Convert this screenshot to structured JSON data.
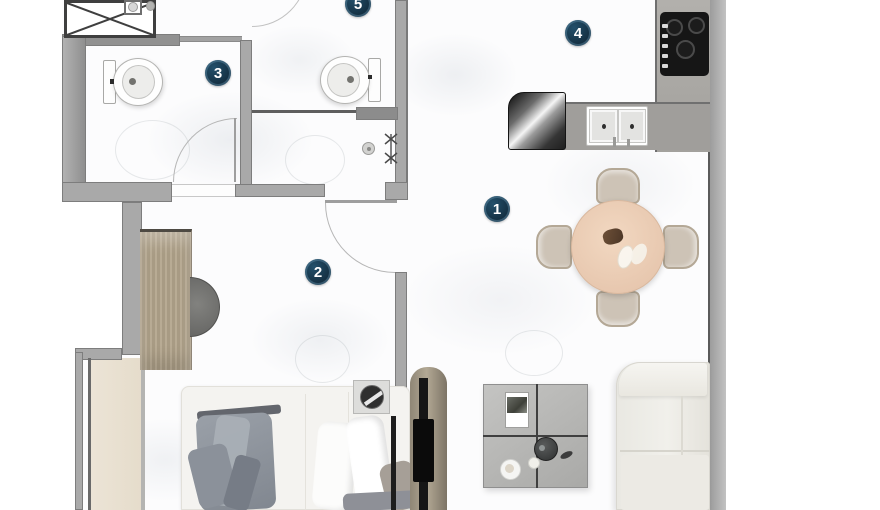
{
  "plan": {
    "type": "apartment-floor-plan",
    "badges": [
      {
        "label": "1"
      },
      {
        "label": "2"
      },
      {
        "label": "3"
      },
      {
        "label": "4"
      },
      {
        "label": "5"
      }
    ],
    "badge_style": {
      "background": "#17384a",
      "rim": "#5c8ba7",
      "text_color": "#ffffff"
    },
    "colors": {
      "wall": "#a9a9a9",
      "wall_edge": "#7d7d7d",
      "floor": "#fcfcfd",
      "balcony_floor": "#e9e1d2",
      "wood_wardrobe": "#b0a38c",
      "dining_table": "#edcfb6",
      "chair": "#cdc3b6",
      "sofa": "#edece7",
      "coffee_table": "#b8b8b6",
      "kitchen_counter": "#a3a19d",
      "cooktop": "#161616",
      "tv_wall": "#a89d8a",
      "blanket": "#949aa2"
    },
    "fixtures": [
      "elevator-shaft-icon",
      "washbasin-icon",
      "toilet-icon",
      "toilet-icon",
      "shower-valve-icon",
      "floor-drain-icon",
      "door-arc-icon",
      "door-arc-icon",
      "door-arc-icon",
      "cooktop-icon",
      "kitchen-sink-icon",
      "refrigerator-icon",
      "dining-table",
      "dining-chair",
      "sofa",
      "coffee-table",
      "bed",
      "pillow",
      "blanket",
      "wardrobe",
      "stool",
      "tv-unit",
      "speaker",
      "balcony-floor"
    ]
  }
}
